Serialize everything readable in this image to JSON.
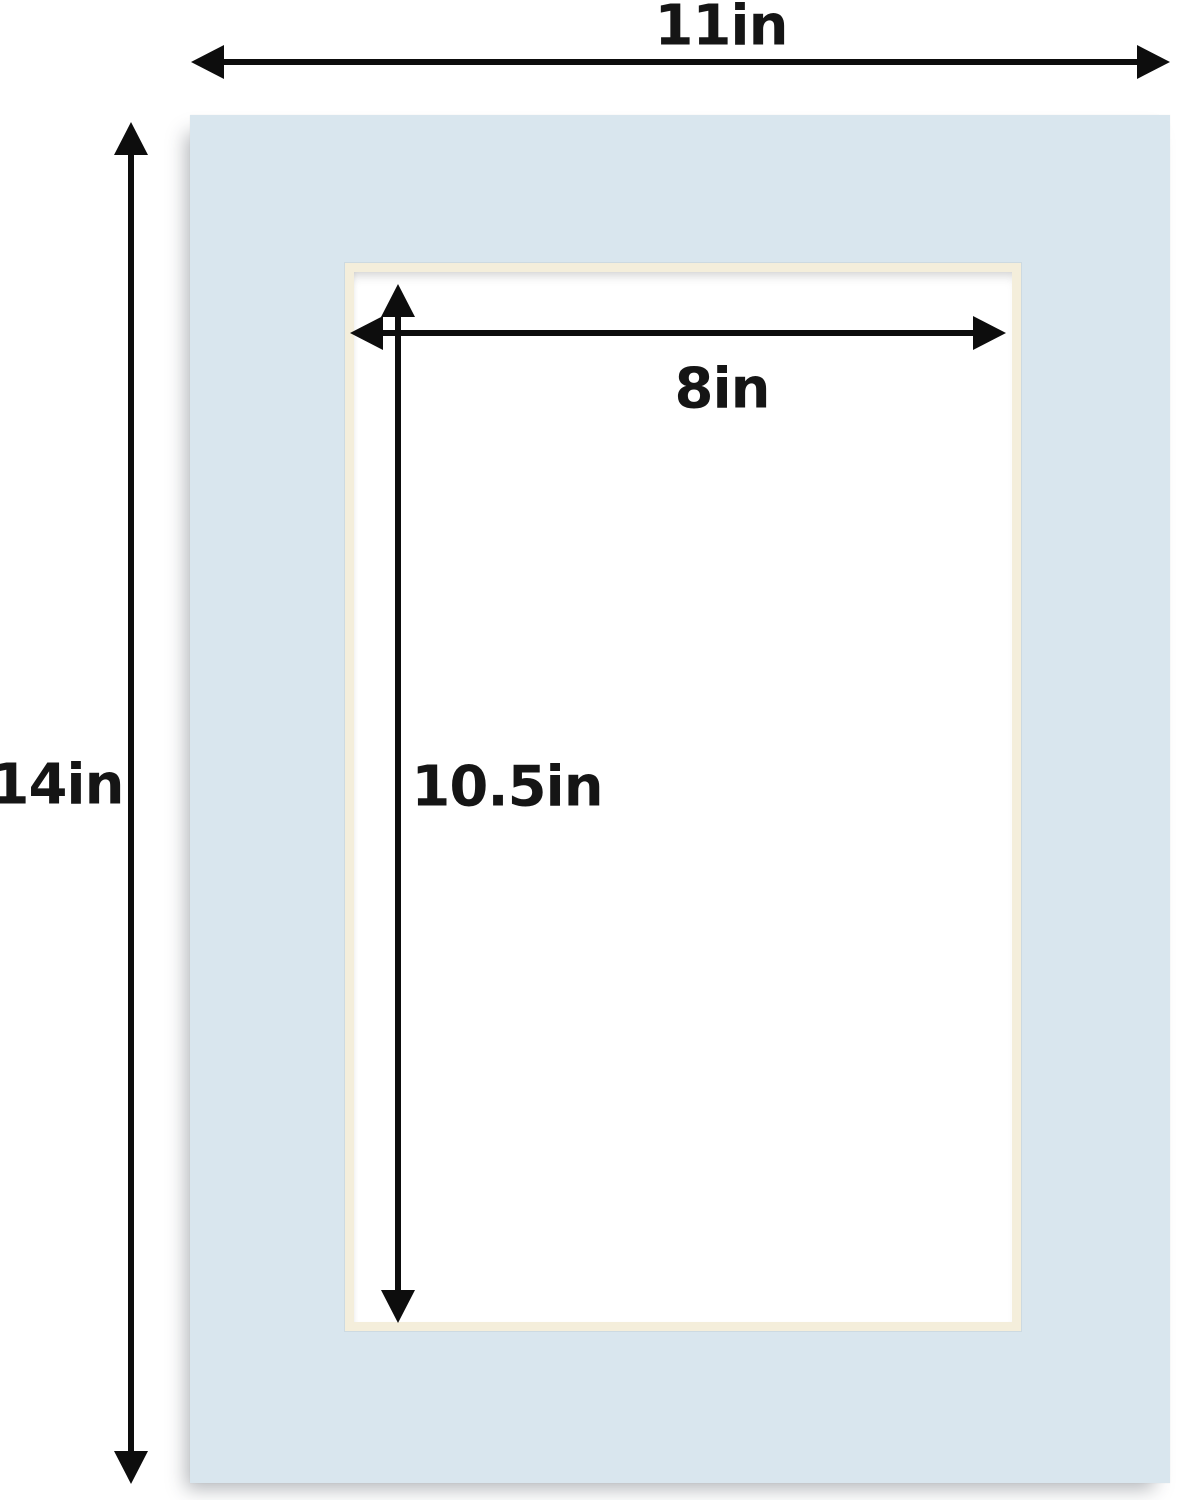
{
  "diagram": {
    "labels": {
      "outer_width": "11in",
      "outer_height": "14in",
      "opening_width": "8in",
      "opening_height": "10.5in"
    },
    "values": {
      "outer_width_in": 11,
      "outer_height_in": 14,
      "opening_width_in": 8,
      "opening_height_in": 10.5
    },
    "colors": {
      "mat": "#d9e6ee",
      "bevel": "#f4eedb",
      "opening": "#ffffff",
      "arrow": "#0d0d0d",
      "background": "#ffffff"
    },
    "icons": {
      "outer_width_arrow": "double-arrow-horizontal-icon",
      "outer_height_arrow": "double-arrow-vertical-icon",
      "opening_width_arrow": "double-arrow-horizontal-icon",
      "opening_height_arrow": "double-arrow-vertical-icon"
    }
  }
}
